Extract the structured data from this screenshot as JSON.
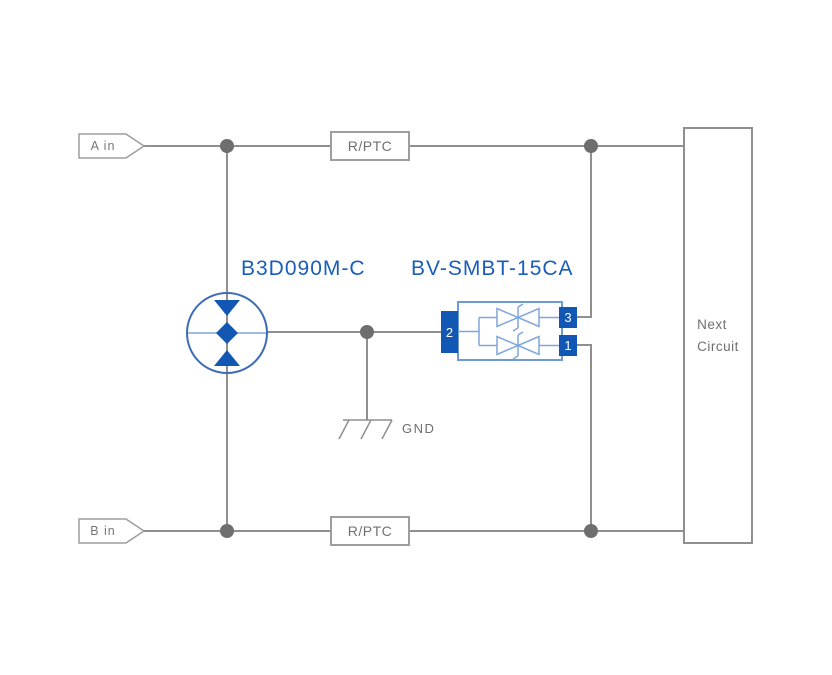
{
  "colors": {
    "wire_gray": "#8f8f8f",
    "junction_dot_gray": "#6e6e6e",
    "box_border_gray": "#9e9e9e",
    "text_gray": "#6f6f6f",
    "component_blue_dark": "#1257b4",
    "component_blue_medium": "#3d6cb6",
    "component_blue_light": "#7ea6dc",
    "part_label_blue": "#1a5dbb"
  },
  "components": {
    "input_a": {
      "label": "A in"
    },
    "input_b": {
      "label": "B in"
    },
    "rptc_top": {
      "label": "R/PTC"
    },
    "rptc_bottom": {
      "label": "R/PTC"
    },
    "gdt": {
      "part_number": "B3D090M-C"
    },
    "tvs": {
      "part_number": "BV-SMBT-15CA",
      "pin1": "1",
      "pin2": "2",
      "pin3": "3"
    },
    "ground": {
      "label": "GND"
    },
    "next_circuit": {
      "line1": "Next",
      "line2": "Circuit"
    }
  }
}
